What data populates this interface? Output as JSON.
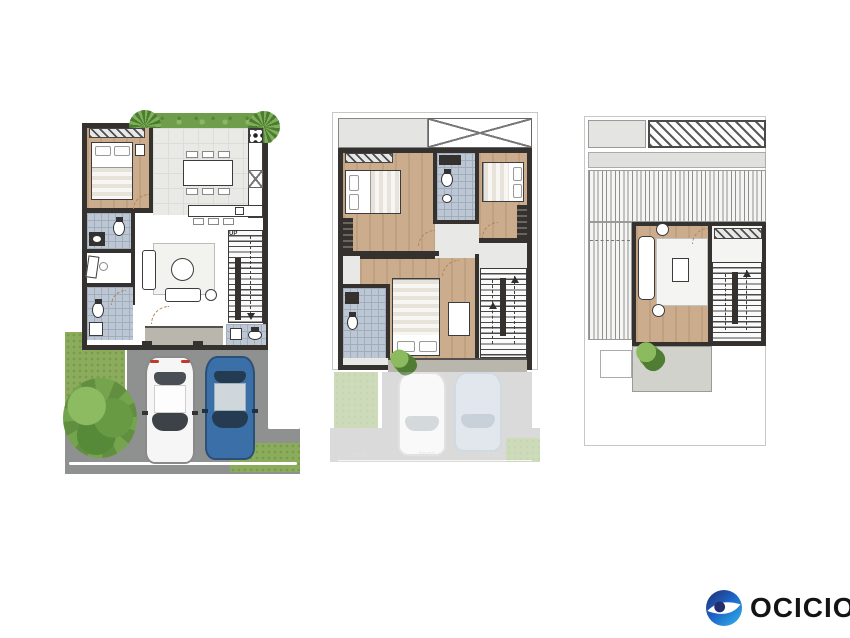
{
  "document": {
    "type": "three-level townhouse floor plan sheet",
    "background": "#ffffff"
  },
  "logo": {
    "text": "OCICIO"
  },
  "plans": {
    "ground_floor": {
      "up_label": "UP"
    },
    "second_floor": {
      "dimensions": [
        "1875",
        "3000",
        "2275"
      ]
    },
    "roof_floor": {}
  },
  "icons": {
    "logo-mark": "blue ring with white swoosh and navy dot",
    "tree": "green canopy blob",
    "palm": "green frond circle",
    "stair-down-arrow": "▼",
    "stair-up-arrow": "▲"
  },
  "colors": {
    "wall": "#35312e",
    "wood_floor": "#cbad8d",
    "tile_floor": "#bdc7d3",
    "light_floor": "#e9e9e6",
    "hedge_green": "#6f9e4b",
    "grass_green": "#8aac5c",
    "driveway_gray": "#8f9090",
    "porch_gray": "#b9b6ae",
    "car_white": "#f6f6f6",
    "car_blue": "#3b6fa7",
    "logo_navy": "#232d6b",
    "logo_blue": "#1d64c8",
    "logo_light_blue": "#2fb0e8"
  }
}
